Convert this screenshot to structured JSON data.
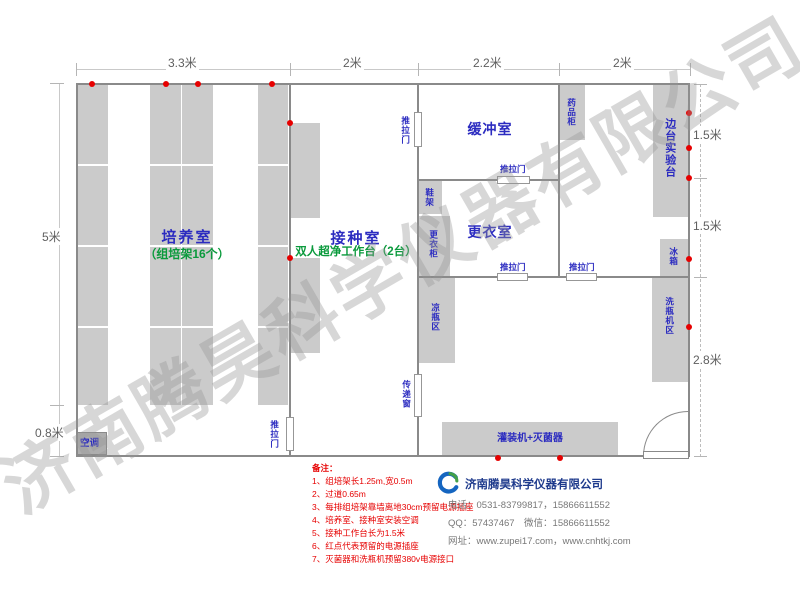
{
  "watermark": "济南腾昊科学仪器有限公司",
  "dimensions": {
    "top": [
      "3.3米",
      "2米",
      "2.2米",
      "2米"
    ],
    "left": [
      "5米",
      "0.8米"
    ],
    "right": [
      "1.5米",
      "1.5米",
      "2.8米"
    ]
  },
  "rooms": {
    "culture": {
      "name": "培养室",
      "sub": "（组培架16个）"
    },
    "inoculation": {
      "name": "接种室",
      "sub": "双人超净工作台（2台）"
    },
    "buffer": {
      "name": "缓冲室"
    },
    "changing": {
      "name": "更衣室"
    },
    "side_bench": {
      "name": "边台实验台"
    }
  },
  "furniture": {
    "sliding_door": "推拉门",
    "shoe_rack": "鞋架",
    "wardrobe": "更衣柜",
    "medicine_cabinet": "药品柜",
    "fridge": "冰箱",
    "cool_bottle_area": "凉瓶区",
    "washer_area": "洗瓶机区",
    "pass_window": "传递窗",
    "filler": "灌装机+灭菌器",
    "ac": "空调"
  },
  "notes": {
    "header": "备注：",
    "items": [
      "1、组培架长1.25m,宽0.5m",
      "2、过道0.65m",
      "3、每排组培架靠墙离地30cm预留电源插座",
      "4、培养室、接种室安装空调",
      "5、接种工作台长为1.5米",
      "6、红点代表预留的电源插座",
      "7、灭菌器和洗瓶机预留380v电源接口"
    ]
  },
  "company": {
    "name": "济南腾昊科学仪器有限公司",
    "phone": "电话：0531-83799817，15866611552",
    "qq": "QQ：57437467　微信：15866611552",
    "website": "网址：www.zupei17.com，www.cnhtkj.com"
  },
  "colors": {
    "wall": "#8a8a8a",
    "furniture_fill": "#cbcbcb",
    "room_label_blue": "#2b2bc0",
    "sub_label_green": "#0a9a3c",
    "note_red": "#e60000",
    "socket_red": "#e60000",
    "logo_blue": "#1565c0",
    "logo_green": "#43a047"
  }
}
